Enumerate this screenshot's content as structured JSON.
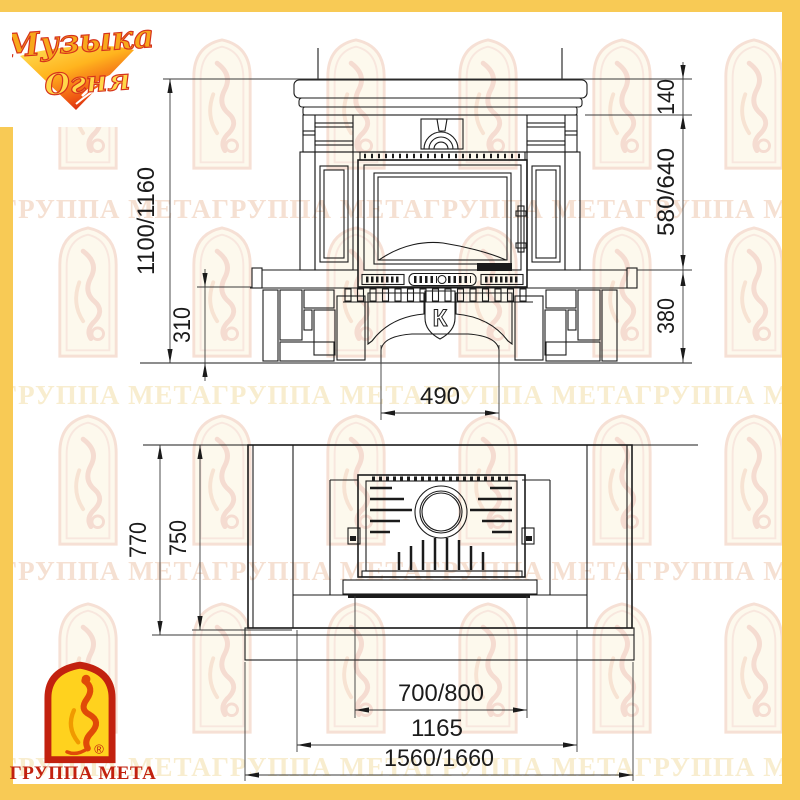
{
  "branding": {
    "top_logo": {
      "word1": "Музыка",
      "word2": "Огня"
    },
    "bottom_logo": {
      "company": "ГРУППА МЕТА",
      "registered": "®"
    }
  },
  "watermark": {
    "row_text": "ГРУППА МЕТАГРУППА МЕТАГРУППА МЕТАГРУППА МЕТАГРУППА МЕТА"
  },
  "drawing": {
    "front_view": {
      "emblem": "К",
      "dims": {
        "overall_height": "1100/1160",
        "cornice_height": "140",
        "firebox_zone_height": "580/640",
        "plinth_height": "310",
        "hearth_height": "380",
        "arch_opening_width": "490"
      }
    },
    "plan_view": {
      "dims": {
        "depth_overall": "770",
        "depth_inner": "750",
        "firebox_width": "700/800",
        "body_width": "1165",
        "overall_width": "1560/1660"
      }
    }
  },
  "colors": {
    "frame": "#f8ca55",
    "line": "#1b1b1b",
    "logo_red": "#c2210f"
  }
}
